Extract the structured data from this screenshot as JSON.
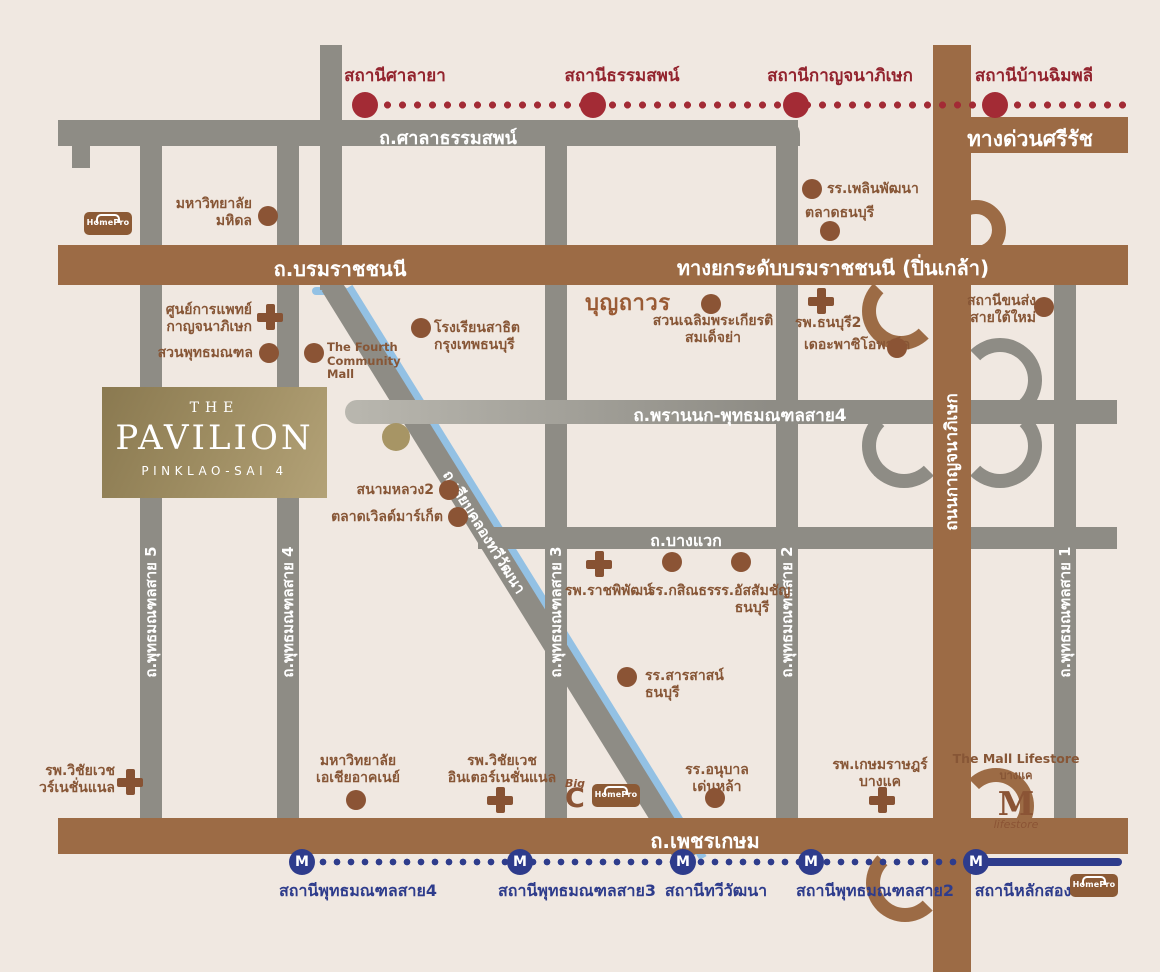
{
  "red_line": {
    "stations": [
      {
        "label": "สถานีศาลายา"
      },
      {
        "label": "สถานีธรรมสพน์"
      },
      {
        "label": "สถานีกาญจนาภิเษก"
      },
      {
        "label": "สถานีบ้านฉิมพลี"
      }
    ]
  },
  "mrt": {
    "m": "M",
    "stations": [
      {
        "label": "สถานีพุทธมณฑลสาย4"
      },
      {
        "label": "สถานีพุทธมณฑลสาย3"
      },
      {
        "label": "สถานีทวีวัฒนา"
      },
      {
        "label": "สถานีพุทธมณฑลสาย2"
      },
      {
        "label": "สถานีหลักสอง"
      }
    ]
  },
  "roads": {
    "sala_thammasop": "ถ.ศาลาธรรมสพน์",
    "si_rat": "ทางด่วนศรีรัช",
    "borommaratchachonnani": "ถ.บรมราชชนนี",
    "elevated_pinklao": "ทางยกระดับบรมราชชนนี (ปิ่นเกล้า)",
    "phran_nok_sai4": "ถ.พรานนก-พุทธมณฑลสาย4",
    "bang_waek": "ถ.บางแวก",
    "phet_kasem": "ถ.เพชรเกษม",
    "kanchanaphisek": "ถนนกาญจนาภิเษก",
    "liap_khlong": "ถ.เลียบคลองทวีวัฒนา",
    "sai5": "ถ.พุทธมณฑลสาย 5",
    "sai4": "ถ.พุทธมณฑลสาย 4",
    "sai3": "ถ.พุทธมณฑลสาย 3",
    "sai2": "ถ.พุทธมณฑลสาย 2",
    "sai1": "ถ.พุทธมณฑลสาย 1"
  },
  "logo": {
    "the": "THE",
    "name": "PAVILION",
    "sub": "PINKLAO-SAI 4"
  },
  "brands": {
    "homepro": "HomePro",
    "boonthavorn": "บุญถาวร",
    "big": "Big",
    "c": "C",
    "mall_title": "The Mall Lifestore",
    "mall_sub": "บางแค",
    "mall_m": "M",
    "mall_script": "lifestore"
  },
  "pois": {
    "mahidol": {
      "l1": "มหาวิทยาลัย",
      "l2": "มหิดล"
    },
    "medcenter": {
      "l1": "ศูนย์การแพทย์",
      "l2": "กาญจนาภิเษก"
    },
    "phutthamonthon_park": {
      "l1": "สวนพุทธมณฑล"
    },
    "fourth_mall": {
      "l1": "The Fourth",
      "l2": "Community",
      "l3": "Mall"
    },
    "satit": {
      "l1": "โรงเรียนสาธิต",
      "l2": "กรุงเทพธนบุรี"
    },
    "chalerm_park": {
      "l1": "สวนเฉลิมพระเกียรติ",
      "l2": "สมเด็จย่า"
    },
    "thonburi2": {
      "l1": "รพ.ธนบุรี2"
    },
    "paseo_park": {
      "l1": "เดอะพาซิโอพาร์ค"
    },
    "plearn_pattana": {
      "l1": "รร.เพลินพัฒนา"
    },
    "talad_thonburi": {
      "l1": "ตลาดธนบุรี"
    },
    "sai_tai_mai": {
      "l1": "สถานีขนส่ง",
      "l2": "สายใต้ใหม่"
    },
    "sanam_luang2": {
      "l1": "สนามหลวง2"
    },
    "world_market": {
      "l1": "ตลาดเวิลด์มาร์เก็ต"
    },
    "ratchaphiphat": {
      "l1": "รพ.ราชพิพัฒน์"
    },
    "kasintorn": {
      "l1": "รร.กสิณธร"
    },
    "assumption": {
      "l1": "รร.อัสสัมชัญ",
      "l2": "ธนบุรี"
    },
    "sarasas": {
      "l1": "รร.สารสาสน์",
      "l2": "ธนบุรี"
    },
    "vichaivej_left": {
      "l1": "รพ.วิชัยเวช",
      "l2": "วร์เนชั่นแนล"
    },
    "sau": {
      "l1": "มหาวิทยาลัย",
      "l2": "เอเชียอาคเนย์"
    },
    "vichaivej": {
      "l1": "รพ.วิชัยเวช",
      "l2": "อินเตอร์เนชั่นแนล"
    },
    "denla": {
      "l1": "รร.อนุบาล",
      "l2": "เด่นหล้า"
    },
    "kasemrad": {
      "l1": "รพ.เกษมราษฎร์",
      "l2": "บางแค"
    }
  },
  "colors": {
    "background": "#F0E8E1",
    "road_gray": "#8E8C85",
    "road_brown": "#9C6B45",
    "rail_red": "#A32B35",
    "mrt_blue": "#2E3C8C",
    "canal_blue": "#93C1E4",
    "poi_brown": "#8B5435",
    "gold_gradient_start": "#8A7950",
    "gold_gradient_end": "#B3A277"
  }
}
